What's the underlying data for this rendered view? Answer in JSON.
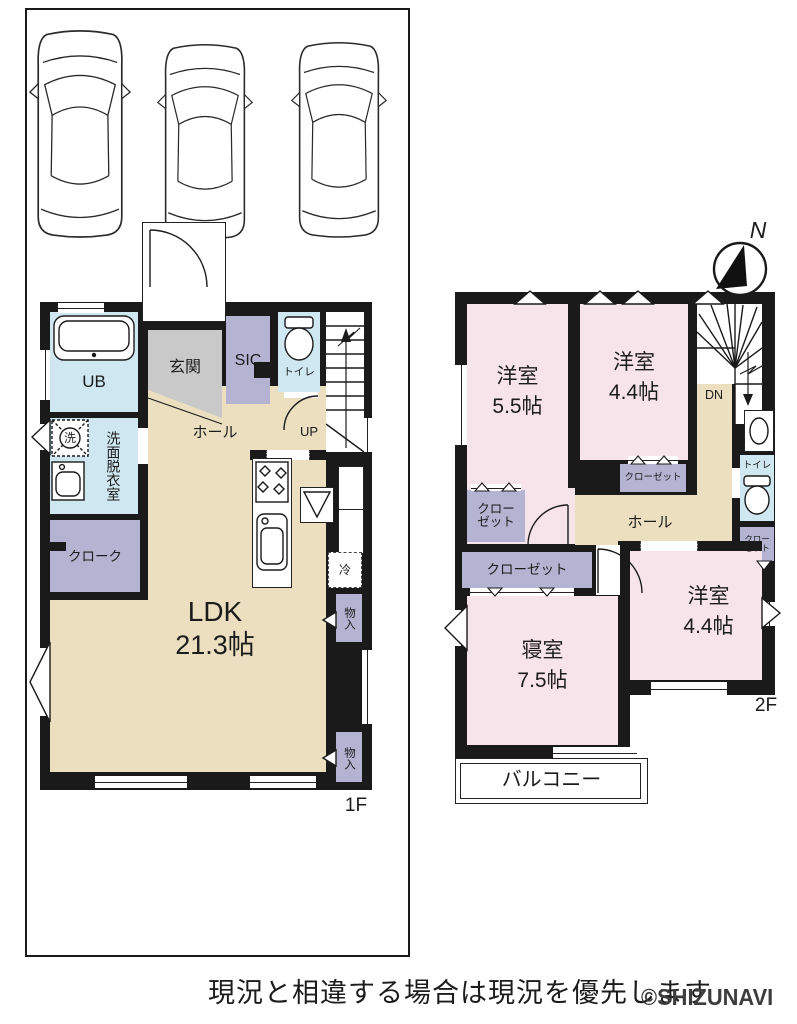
{
  "colors": {
    "wall": "#1a1a1a",
    "floor_tan": "#EBDFC0",
    "closet_purple": "#B4B3D2",
    "wet_blue": "#CFE7F1",
    "room_pink": "#F7E4EA",
    "entry_gray": "#C9C9C9"
  },
  "compass": {
    "label": "N"
  },
  "caption": {
    "text": "現況と相違する場合は現況を優先します",
    "watermark": "©SHIZUNAVI"
  },
  "parking": {
    "car_count": "3"
  },
  "floor1": {
    "name": "1F",
    "rooms": {
      "ub": "UB",
      "genkan": "玄関",
      "sic": "SIC",
      "toilet": "トイレ",
      "hall": "ホール",
      "up": "UP",
      "washer": "洗",
      "senmen": "洗面",
      "datsui": "脱衣室",
      "cloak": "クローク",
      "ldk": "LDK",
      "ldk_size": "21.3帖",
      "fridge": "冷",
      "storage1": "物入",
      "storage2": "物入"
    }
  },
  "floor2": {
    "name": "2F",
    "rooms": {
      "west1": "洋室",
      "west1_size": "5.5帖",
      "west2": "洋室",
      "west2_size": "4.4帖",
      "dn": "DN",
      "toilet": "トイレ",
      "closet_top": "クローゼット",
      "closet_left_1": "クロー",
      "closet_left_2": "ゼット",
      "closet_main": "クローゼット",
      "closet_right_1": "クロー",
      "closet_right_2": "ゼット",
      "hall": "ホール",
      "bedroom": "寝室",
      "bedroom_size": "7.5帖",
      "west3": "洋室",
      "west3_size": "4.4帖",
      "balcony": "バルコニー"
    }
  }
}
